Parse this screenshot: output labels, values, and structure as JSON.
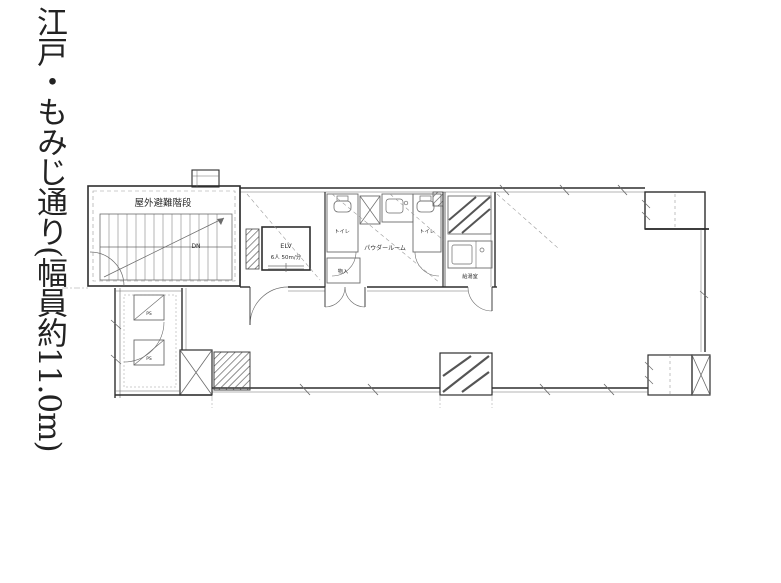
{
  "street_sign": {
    "text": "江戸・もみじ通り(幅員約11.0m)"
  },
  "floor_plan": {
    "labels": {
      "evacuation_stairs": "屋外避難階段",
      "down": "DN",
      "elevator": "ELV",
      "elevator_spec": "6人 50m/分",
      "toilet_left": "トイレ",
      "toilet_right": "トイレ",
      "powder_room": "パウダールーム",
      "kitchenette": "給湯室",
      "closet": "物入",
      "pipe_shaft_upper": "PS",
      "pipe_shaft_lower": "PS"
    },
    "colors": {
      "wall": "#2e2e2e",
      "secondary_line": "#6b6b6b",
      "light_line": "#9a9a9a",
      "background": "#ffffff"
    }
  }
}
